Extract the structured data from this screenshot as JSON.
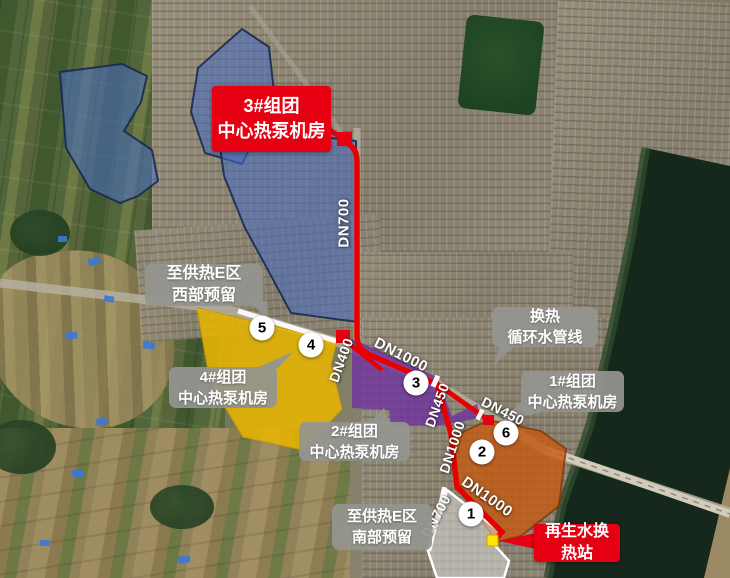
{
  "callouts": [
    {
      "id": "cluster3-pump-room",
      "style": "red",
      "line1": "3#组团",
      "line2": "中心热泵机房"
    },
    {
      "id": "west-reserve",
      "style": "gray",
      "line1": "至供热E区",
      "line2": "西部预留"
    },
    {
      "id": "heat-exchange-pipeline",
      "style": "gray",
      "line1": "换热",
      "line2": "循环水管线"
    },
    {
      "id": "cluster1-pump-room",
      "style": "gray",
      "line1": "1#组团",
      "line2": "中心热泵机房"
    },
    {
      "id": "cluster4-pump-room",
      "style": "gray",
      "line1": "4#组团",
      "line2": "中心热泵机房"
    },
    {
      "id": "cluster2-pump-room",
      "style": "gray",
      "line1": "2#组团",
      "line2": "中心热泵机房"
    },
    {
      "id": "south-reserve",
      "style": "gray",
      "line1": "至供热E区",
      "line2": "南部预留"
    },
    {
      "id": "reclaimed-water-station",
      "style": "red",
      "line1": "再生水换",
      "line2": "热站"
    }
  ],
  "pipes": [
    {
      "id": "dn700-north",
      "label": "DN700"
    },
    {
      "id": "dn1000-main",
      "label": "DN1000"
    },
    {
      "id": "dn400-branch",
      "label": "DN400"
    },
    {
      "id": "dn450-steep",
      "label": "DN450"
    },
    {
      "id": "dn450-east",
      "label": "DN450"
    },
    {
      "id": "dn1000-vertical",
      "label": "DN1000"
    },
    {
      "id": "dn1000-south",
      "label": "DN1000"
    },
    {
      "id": "dn700-south",
      "label": "DN700"
    }
  ],
  "markers": [
    {
      "label": "1"
    },
    {
      "label": "2"
    },
    {
      "label": "3"
    },
    {
      "label": "4"
    },
    {
      "label": "5"
    },
    {
      "label": "6"
    }
  ],
  "colors": {
    "route_red": "#e80000",
    "callout_red": "#e60012",
    "callout_gray": "#94948f",
    "zone_blue": "#4a6cc0",
    "zone_yellow": "#eab600",
    "zone_purple": "#7030a0",
    "zone_orange": "#c55a11",
    "zone_gray": "#dcdcdc",
    "reserve_line": "#ffffff",
    "node_yellow": "#ffe600"
  }
}
